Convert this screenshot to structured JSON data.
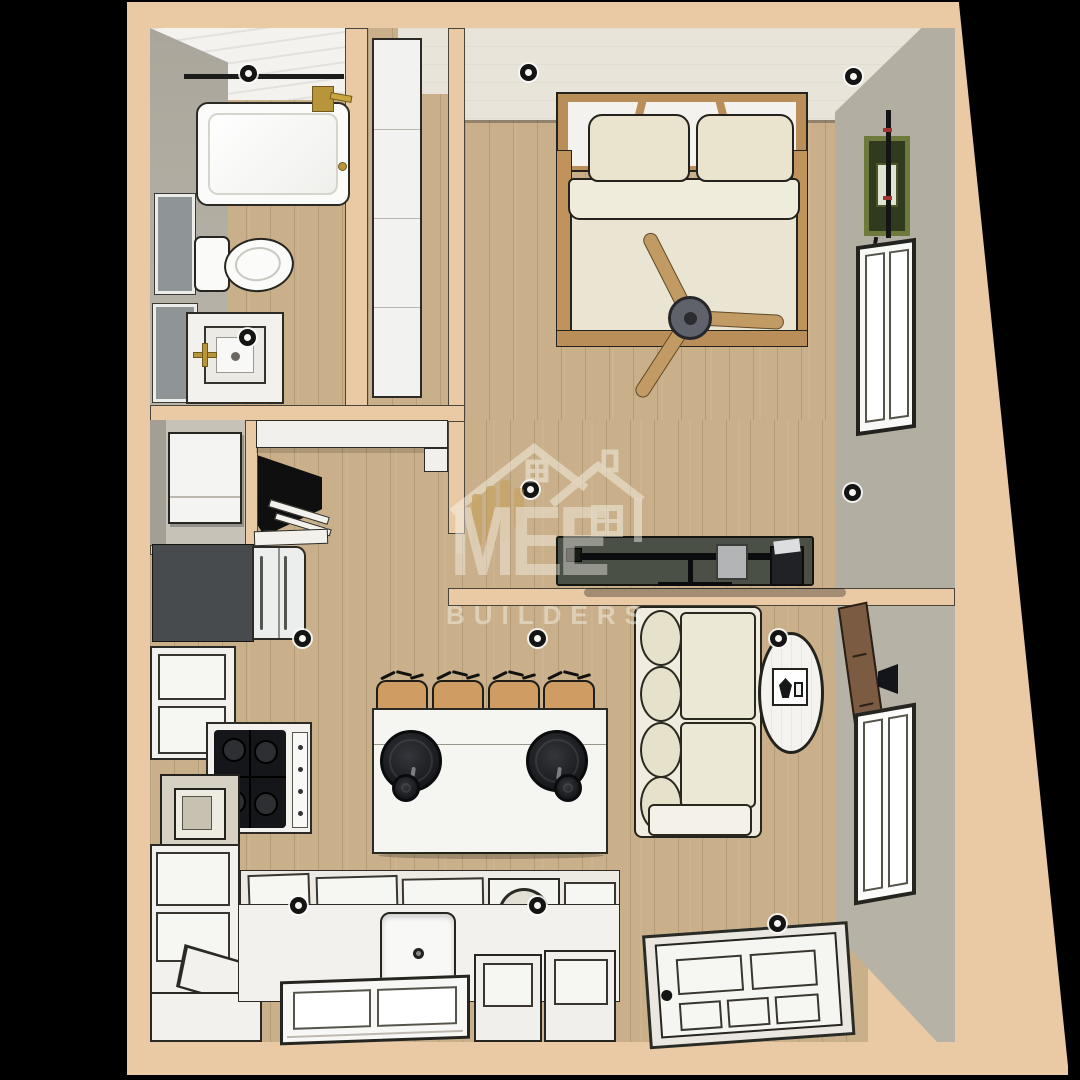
{
  "watermark": {
    "brand": "MEE",
    "tagline": "BUILDERS"
  },
  "scene": {
    "type": "3D floor plan render, top-down dollhouse view",
    "background": "#000000",
    "palette": {
      "exterior_wall": "#e9caa5",
      "wood_floor": "#c9b08a",
      "ceiling": "#e9e4d9",
      "accent_wall_gray": "#b2aea2",
      "cabinet_white": "#f2f1ed",
      "console_dark_green": "#4b5047",
      "stool_tan": "#cf9d63",
      "fixture_gold": "#b8943a",
      "art_frame_green": "#6d7a3b",
      "wall_panel_brown": "#7b5c42",
      "pendant_black": "#141518"
    },
    "rooms": [
      {
        "name": "bathroom",
        "furniture": [
          "bathtub",
          "shower fixture",
          "toilet",
          "vanity sink",
          "wall mirror",
          "wall mirror"
        ]
      },
      {
        "name": "closet",
        "furniture": [
          "tall shelf unit"
        ]
      },
      {
        "name": "laundry closet",
        "furniture": [
          "appliance"
        ]
      },
      {
        "name": "bedroom",
        "furniture": [
          "double bed",
          "pillows",
          "ceiling fan",
          "media console",
          "flat tv",
          "green picture frame",
          "window"
        ]
      },
      {
        "name": "kitchen",
        "furniture": [
          "refrigerator",
          "gas cooktop",
          "range hood",
          "corner tv",
          "island",
          "bar stools x4",
          "pendant lights x2",
          "sink",
          "cabinets",
          "window"
        ]
      },
      {
        "name": "living room",
        "furniture": [
          "sofa",
          "oval rug",
          "side table",
          "wall panel tv",
          "storage benches x2",
          "entry door",
          "window"
        ]
      }
    ],
    "lighting": {
      "recessed_lights": 12,
      "pendants": 2
    }
  }
}
